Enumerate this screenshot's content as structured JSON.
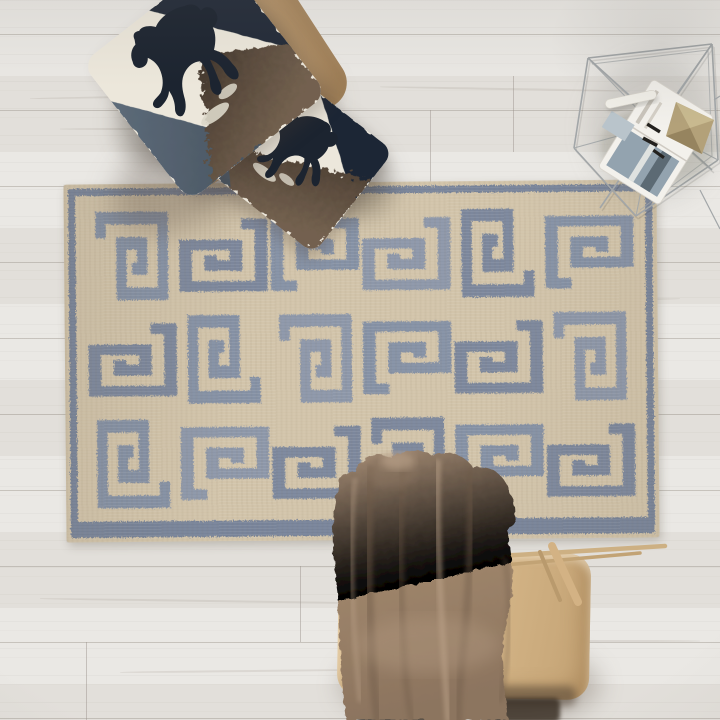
{
  "scene": {
    "type": "product-photography-flat-lay",
    "view": "top-down overhead room scene",
    "description": "Overhead view of a cream and slate-blue Greek key kilim rug on a whitewashed wide-plank wood floor, styled with a camel leather ottoman stacked with two rearing-horse print pillows, a geometric wire side table holding an open magazine and papers, and a taupe wool throw draped over a beige leather bench."
  },
  "colors": {
    "floor-base": "#e7e4e0",
    "plank-line": "#968f88",
    "rug-base": "#d2c4aa",
    "rug-pattern": "#8591a5",
    "rug-pattern-dark": "#78849a",
    "rug-pattern-light": "#939cae",
    "pillow-white": "#ece7db",
    "horse-black": "#1c2430",
    "denim-blue": "#556372",
    "fur-dark": "#2e261f",
    "fur-mid": "#594a3c",
    "fur-light": "#73614f",
    "ottoman-tan": "#c4a378",
    "bench-tan": "#d5b688",
    "blanket-mid": "#a18872",
    "blanket-dark": "#7e6955",
    "blanket-light": "#bfa68d",
    "wire-gray": "#a2a6a8",
    "magazine-white": "#f3f1ec",
    "kraft-tan": "#b3a179"
  },
  "rug": {
    "name": "greek-key-kilim-area-rug",
    "pattern": "oversized greek key meander, flatweave with zigzag thread edges",
    "cols": 6,
    "rows": 3,
    "motif_path": "M8,30 V8 H92 V92 H36 V36 H64 V64 H50",
    "shade_colors": [
      "#8591a5",
      "#7b879c",
      "#8d97a9"
    ],
    "cells": [
      {
        "rotate": 0,
        "shade": 0
      },
      {
        "rotate": 90,
        "shade": 1
      },
      {
        "rotate": 270,
        "shade": 0
      },
      {
        "rotate": 90,
        "shade": 2
      },
      {
        "rotate": 180,
        "shade": 1
      },
      {
        "rotate": 270,
        "shade": 0
      },
      {
        "rotate": 90,
        "shade": 1
      },
      {
        "rotate": 180,
        "shade": 0
      },
      {
        "rotate": 0,
        "shade": 2
      },
      {
        "rotate": 270,
        "shade": 0
      },
      {
        "rotate": 90,
        "shade": 1
      },
      {
        "rotate": 0,
        "shade": 2
      },
      {
        "rotate": 180,
        "shade": 0
      },
      {
        "rotate": 270,
        "shade": 2
      },
      {
        "rotate": 90,
        "shade": 1
      },
      {
        "rotate": 0,
        "shade": 1
      },
      {
        "rotate": 270,
        "shade": 0
      },
      {
        "rotate": 90,
        "shade": 1
      }
    ]
  },
  "objects": {
    "ottoman": {
      "name": "camel-leather-ottoman"
    },
    "pillow_top": {
      "name": "horse-print-pillow",
      "motif": "black rearing horse silhouette with embroidered clouds",
      "panels": "white felt, washed denim, dark faux fur"
    },
    "pillow_bottom": {
      "name": "horse-print-pillow",
      "motif": "black rearing horse silhouette with embroidered clouds",
      "panels": "white felt, washed denim, dark faux fur"
    },
    "side_table": {
      "name": "geometric-wire-side-table",
      "items": [
        "open magazine with landscape photo",
        "kraft folded map",
        "rolled white paper",
        "black clips",
        "blue-gray card"
      ]
    },
    "bench": {
      "name": "beige-leather-bench",
      "frame": "light wood dowel frame"
    },
    "throw": {
      "name": "taupe-wool-throw-blanket"
    }
  }
}
